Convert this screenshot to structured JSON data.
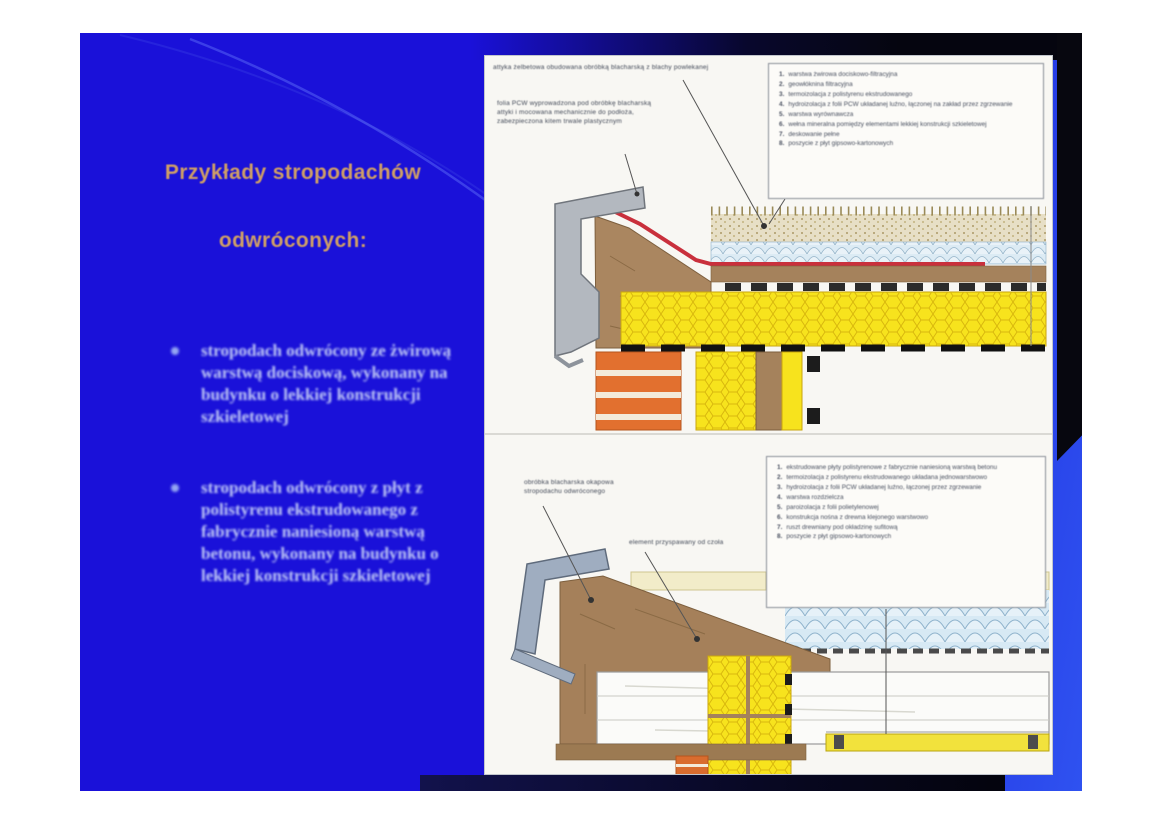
{
  "slide": {
    "title": {
      "line1": "Przykłady stropodachów",
      "line2": "odwróconych:"
    },
    "bullets": [
      "stropodach odwrócony ze żwirową warstwą dociskową, wykonany na budynku o lekkiej konstrukcji szkieletowej",
      "stropodach odwrócony z płyt z polistyrenu ekstrudowanego z fabrycznie naniesioną warstwą betonu, wykonany na budynku o lekkiej konstrukcji szkieletowej"
    ],
    "colors": {
      "slide_background": "#1a11d9",
      "title_text": "#cf9f66",
      "bullet_text": "#c2cbf6",
      "panel_background": "#f8f7f3",
      "membrane_red": "#c9303c",
      "insulation_yellow": "#f7e31d",
      "xps_blue": "#dcebf4",
      "brick_orange": "#e2702f"
    }
  },
  "panel": {
    "upper_diagram": {
      "annotations": [
        "attyka żelbetowa obudowana obróbką blacharską z blachy powlekanej",
        "folia PCW wyprowadzona pod obróbkę blacharską attyki i mocowana mechanicznie do podłoża, zabezpieczona kitem trwale plastycznym"
      ],
      "legend": [
        "warstwa żwirowa dociskowo-filtracyjna",
        "geowłóknina filtracyjna",
        "termoizolacja z polistyrenu ekstrudowanego",
        "hydroizolacja z folii PCW układanej luźno, łączonej na zakład przez zgrzewanie",
        "warstwa wyrównawcza",
        "wełna mineralna pomiędzy elementami lekkiej konstrukcji szkieletowej",
        "deskowanie pełne",
        "poszycie z płyt gipsowo-kartonowych"
      ]
    },
    "lower_diagram": {
      "annotations": [
        "obróbka blacharska okapowa stropodachu odwróconego",
        "element przyspawany od czoła"
      ],
      "legend": [
        "ekstrudowane płyty polistyrenowe z fabrycznie naniesioną warstwą betonu",
        "termoizolacja z polistyrenu ekstrudowanego układana jednowarstwowo",
        "hydroizolacja z folii PCW układanej luźno, łączonej przez zgrzewanie",
        "warstwa rozdzielcza",
        "paroizolacja z folii polietylenowej",
        "konstrukcja nośna z drewna klejonego warstwowo",
        "ruszt drewniany pod okładzinę sufitową",
        "poszycie z płyt gipsowo-kartonowych"
      ]
    }
  }
}
